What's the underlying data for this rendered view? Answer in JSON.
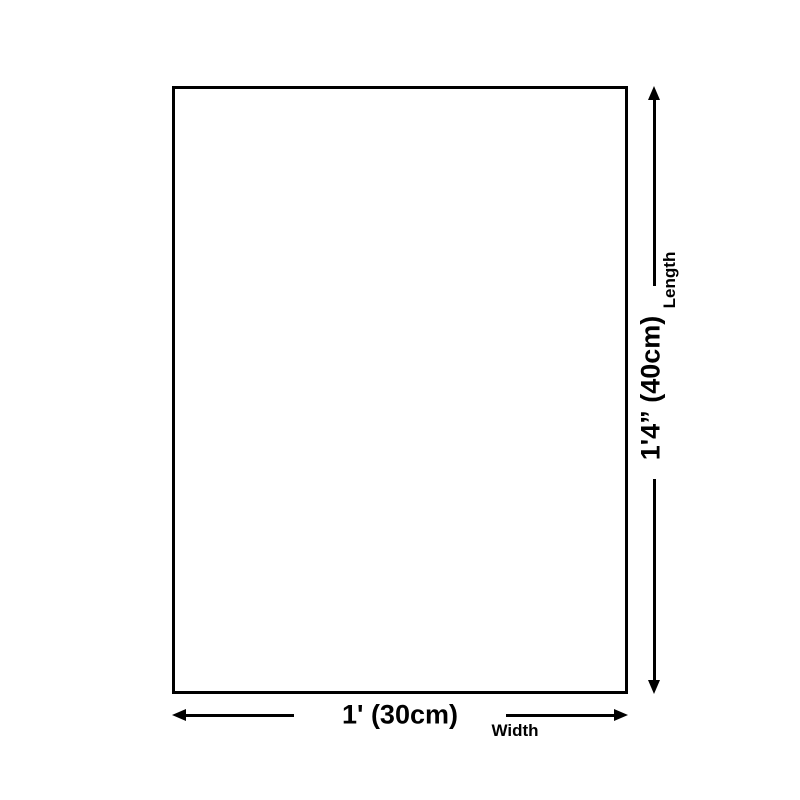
{
  "diagram": {
    "type": "product-size-diagram",
    "colors": {
      "line": "#000000",
      "background": "#ffffff"
    },
    "dimensions": {
      "length": {
        "value": "1'4” (40cm)",
        "label": "Length"
      },
      "width": {
        "value": "1' (30cm)",
        "label": "Width"
      }
    }
  }
}
